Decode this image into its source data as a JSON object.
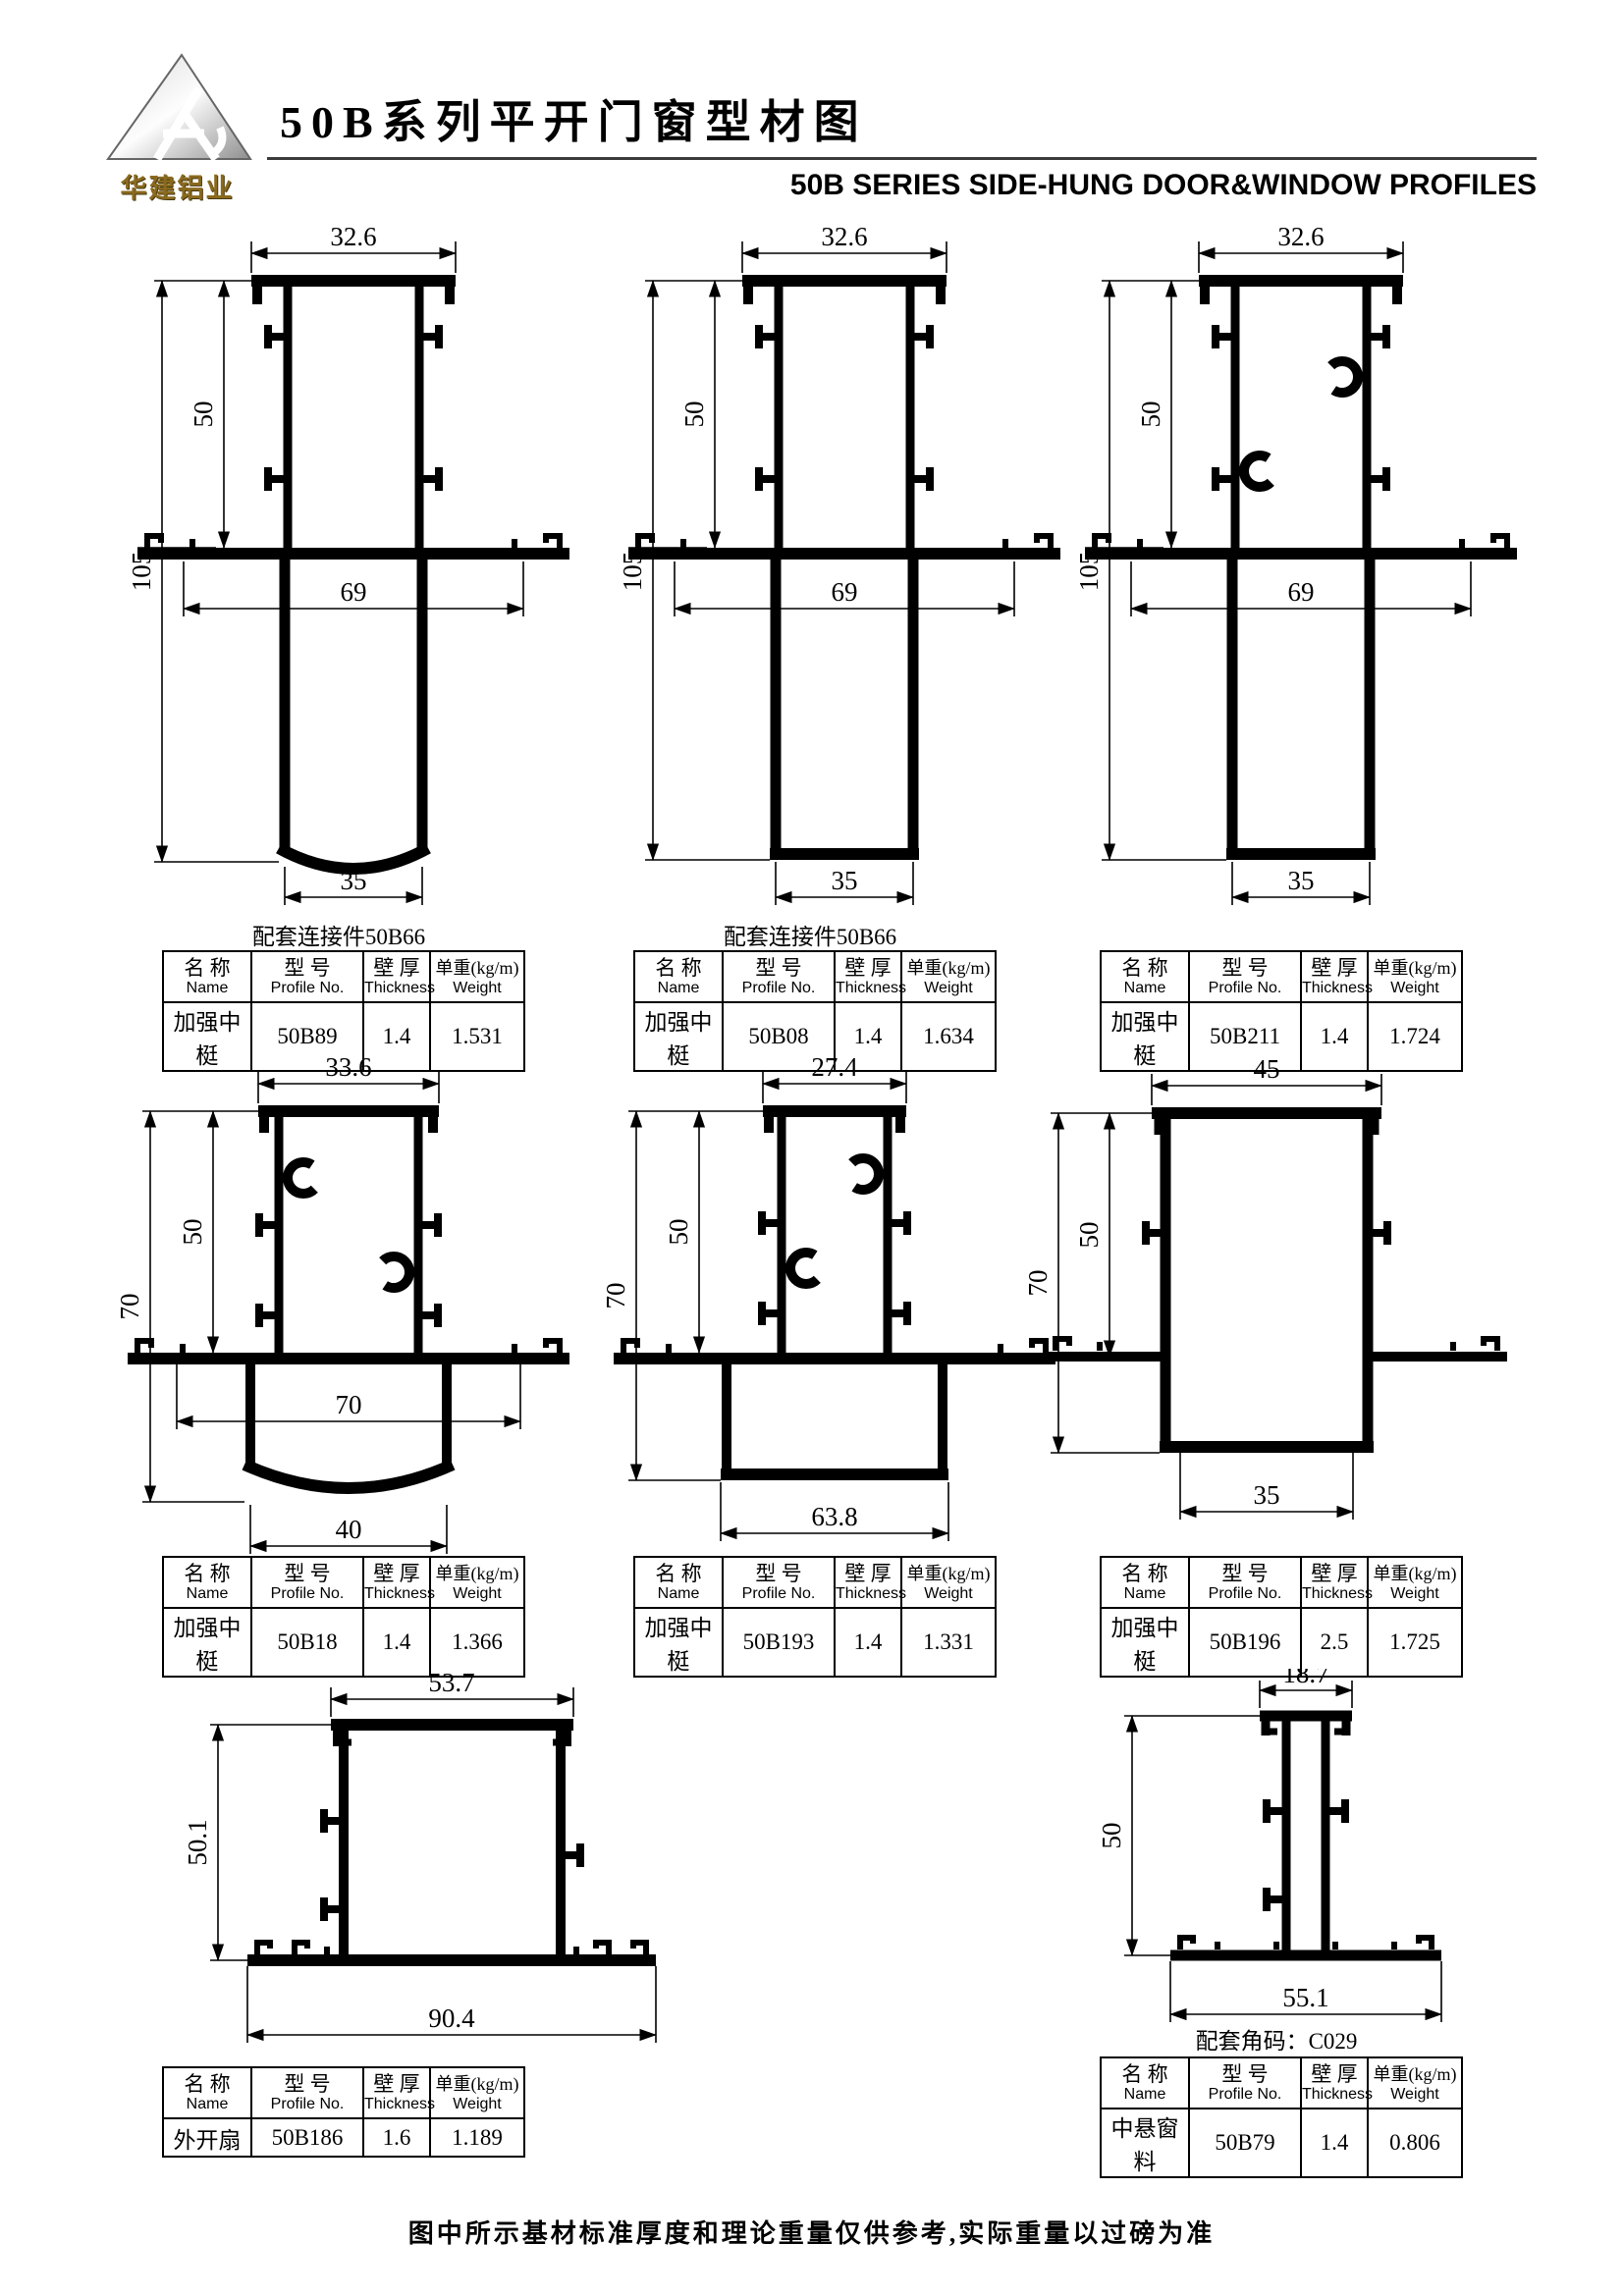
{
  "header": {
    "logo_text": "华建铝业",
    "title": "50B系列平开门窗型材图",
    "subtitle": "50B SERIES SIDE-HUNG DOOR&WINDOW PROFILES"
  },
  "table_headers": {
    "name_cn": "名 称",
    "name_en": "Name",
    "model_cn": "型 号",
    "model_en": "Profile No.",
    "thickness_cn": "壁 厚",
    "thickness_en": "Thickness",
    "weight_cn": "单重(kg/m)",
    "weight_en": "Weight"
  },
  "profiles": [
    {
      "name": "加强中梃",
      "model": "50B89",
      "thickness": "1.4",
      "weight": "1.531",
      "caption": "配套连接件50B66",
      "dims": {
        "top": "32.6",
        "h1": "50",
        "h2": "105",
        "mid": "69",
        "bottom": "35"
      }
    },
    {
      "name": "加强中梃",
      "model": "50B08",
      "thickness": "1.4",
      "weight": "1.634",
      "caption": "配套连接件50B66",
      "dims": {
        "top": "32.6",
        "h1": "50",
        "h2": "105",
        "mid": "69",
        "bottom": "35"
      }
    },
    {
      "name": "加强中梃",
      "model": "50B211",
      "thickness": "1.4",
      "weight": "1.724",
      "caption": "",
      "dims": {
        "top": "32.6",
        "h1": "50",
        "h2": "105",
        "mid": "69",
        "bottom": "35"
      }
    },
    {
      "name": "加强中梃",
      "model": "50B18",
      "thickness": "1.4",
      "weight": "1.366",
      "caption": "",
      "dims": {
        "top": "33.6",
        "h1": "50",
        "h2": "70",
        "mid": "70",
        "bottom": "40"
      }
    },
    {
      "name": "加强中梃",
      "model": "50B193",
      "thickness": "1.4",
      "weight": "1.331",
      "caption": "",
      "dims": {
        "top": "27.4",
        "h1": "50",
        "h2": "70",
        "bottom": "63.8"
      }
    },
    {
      "name": "加强中梃",
      "model": "50B196",
      "thickness": "2.5",
      "weight": "1.725",
      "caption": "",
      "dims": {
        "top": "45",
        "h1": "50",
        "h2": "70",
        "bottom": "35"
      }
    },
    {
      "name": "外开扇",
      "model": "50B186",
      "thickness": "1.6",
      "weight": "1.189",
      "caption": "",
      "dims": {
        "top": "53.7",
        "h1": "50.1",
        "bottom": "90.4"
      }
    },
    {
      "name": "中悬窗料",
      "model": "50B79",
      "thickness": "1.4",
      "weight": "0.806",
      "caption": "配套角码：C029",
      "dims": {
        "top": "18.7",
        "h1": "50",
        "bottom": "55.1"
      }
    }
  ],
  "footer": {
    "note": "图中所示基材标准厚度和理论重量仅供参考,实际重量以过磅为准"
  }
}
